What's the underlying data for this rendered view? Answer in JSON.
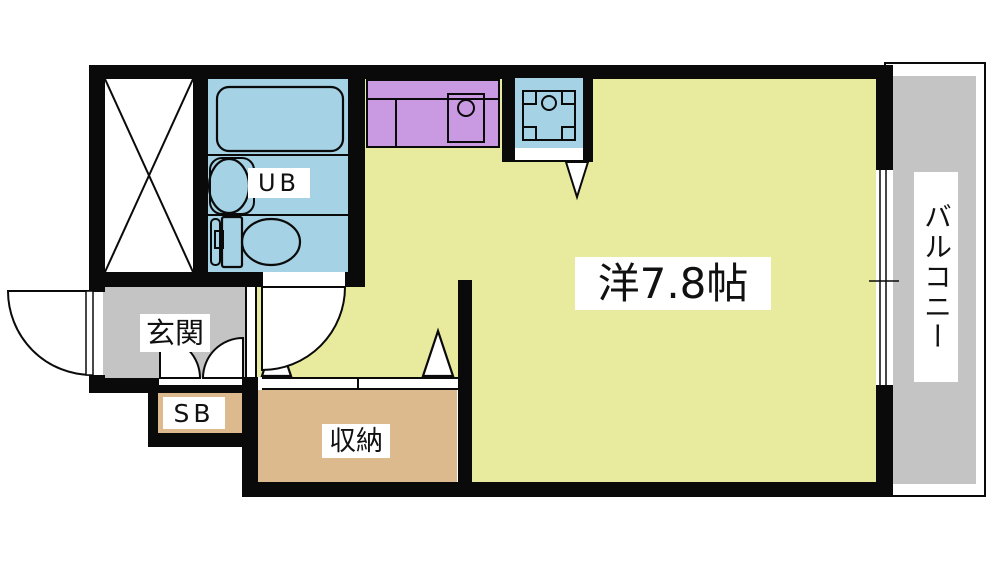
{
  "plan": {
    "title": "apartment-floor-plan",
    "rooms": {
      "main_room": {
        "label": "洋7.8帖"
      },
      "entrance": {
        "label": "玄関"
      },
      "shoe_box": {
        "label": "SB"
      },
      "storage": {
        "label": "収納"
      },
      "unit_bath": {
        "label": "UB"
      },
      "balcony": {
        "label": "バルコニー"
      }
    },
    "colors": {
      "wall": "#0a0a0a",
      "room_floor": "#e8eb9d",
      "bath_floor": "#a5d2e4",
      "kitchen_counter": "#c99ae2",
      "storage_floor": "#dcba8e",
      "entrance_floor": "#c4c4c4",
      "balcony_floor": "#c4c4c4",
      "label_background": "#ffffff"
    },
    "fixtures": [
      "bathtub",
      "washbasin",
      "toilet",
      "kitchen-sink",
      "washing-machine-pan",
      "duct-shaft-cross",
      "entrance-door-swing",
      "bath-door-swing",
      "shoe-box-double-doors",
      "closet-sliding-doors",
      "balcony-sliding-window"
    ]
  }
}
